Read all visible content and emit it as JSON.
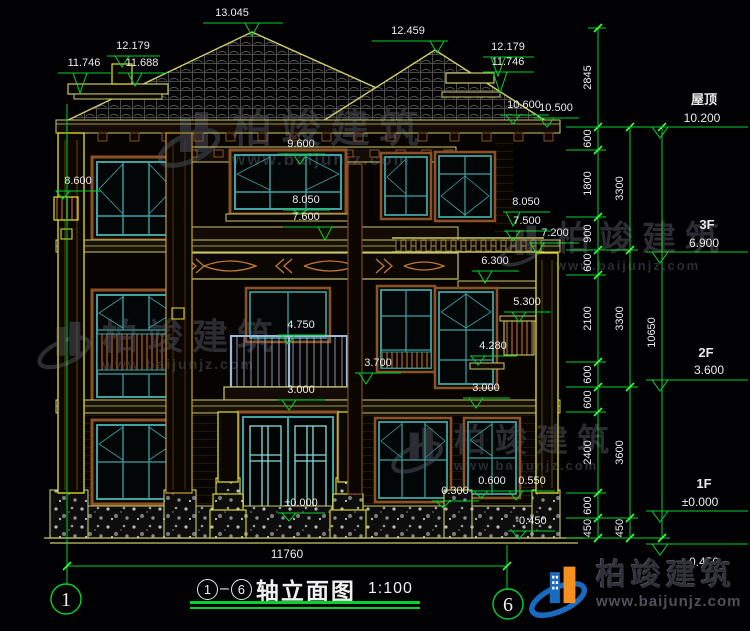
{
  "title_block": {
    "axis_start": "1",
    "axis_end": "6",
    "title": "轴立面图",
    "scale": "1:100"
  },
  "axis_bubbles": {
    "left": "1",
    "right": "6"
  },
  "bottom_dim": {
    "value": "11760"
  },
  "watermark": {
    "brand": "柏竣建筑",
    "url": "www.baijunjz.com"
  },
  "colors": {
    "dim_green": "#00d32d",
    "tick_green": "#3dff3d",
    "text_white": "#ececec",
    "khaki": "#c9c96b",
    "yellow": "#e6e22e",
    "teal": "#3fa3a3",
    "brown": "#8a5226",
    "logo_blue": "#1a6ac0",
    "logo_orange": "#f5901e"
  },
  "elevation_markers": [
    {
      "v": "13.045",
      "tx": 232,
      "ty": 16,
      "x1": 203,
      "x2": 283,
      "ly": 23,
      "ax": 252,
      "ay": 36
    },
    {
      "v": "12.459",
      "tx": 408,
      "ty": 34,
      "x1": 372,
      "x2": 448,
      "ly": 41,
      "ax": 437,
      "ay": 53
    },
    {
      "v": "12.179",
      "tx": 133,
      "ty": 49,
      "x1": 107,
      "x2": 160,
      "ly": 56,
      "ax": 122,
      "ay": 67
    },
    {
      "v": "11.746",
      "tx": 84,
      "ty": 66,
      "x1": 58,
      "x2": 112,
      "ly": 73,
      "ax": 80,
      "ay": 93
    },
    {
      "v": "11.688",
      "tx": 142,
      "ty": 66,
      "x1": 118,
      "x2": 168,
      "ly": 73,
      "ax": 135,
      "ay": 86
    },
    {
      "v": "12.179",
      "tx": 508,
      "ty": 50,
      "x1": 483,
      "x2": 534,
      "ly": 57,
      "ax": 498,
      "ay": 76
    },
    {
      "v": "11.746",
      "tx": 508,
      "ty": 65,
      "x1": 483,
      "x2": 534,
      "ly": 72,
      "ax": 500,
      "ay": 93
    },
    {
      "v": "10.600",
      "tx": 524,
      "ty": 108,
      "x1": 500,
      "x2": 549,
      "ly": 115,
      "ax": 513,
      "ay": 124
    },
    {
      "v": "10.500",
      "tx": 556,
      "ty": 111,
      "x1": 534,
      "x2": 579,
      "ly": 118,
      "ax": 547,
      "ay": 127
    },
    {
      "v": "9.600",
      "tx": 301,
      "ty": 147,
      "x1": 278,
      "x2": 325,
      "ly": 154,
      "ax": 300,
      "ay": 164
    },
    {
      "v": "8.600",
      "tx": 78,
      "ty": 184,
      "x1": 56,
      "x2": 101,
      "ly": 191,
      "ax": 63,
      "ay": 199
    },
    {
      "v": "8.050",
      "tx": 306,
      "ty": 203,
      "x1": 283,
      "x2": 330,
      "ly": 210,
      "ax": 300,
      "ay": 214
    },
    {
      "v": "7.600",
      "tx": 306,
      "ty": 220,
      "x1": 283,
      "x2": 330,
      "ly": 227,
      "ax": 325,
      "ay": 240
    },
    {
      "v": "8.050",
      "tx": 526,
      "ty": 205,
      "x1": 503,
      "x2": 550,
      "ly": 212,
      "ax": 513,
      "ay": 226
    },
    {
      "v": "7.500",
      "tx": 527,
      "ty": 224,
      "x1": 504,
      "x2": 551,
      "ly": 231,
      "ax": 513,
      "ay": 241
    },
    {
      "v": "7.200",
      "tx": 555,
      "ty": 236,
      "x1": 532,
      "x2": 579,
      "ly": 243,
      "ax": 537,
      "ay": 254
    },
    {
      "v": "6.300",
      "tx": 495,
      "ty": 264,
      "x1": 472,
      "x2": 519,
      "ly": 271,
      "ax": 485,
      "ay": 283
    },
    {
      "v": "5.300",
      "tx": 527,
      "ty": 305,
      "x1": 504,
      "x2": 551,
      "ly": 312,
      "ax": 519,
      "ay": 322
    },
    {
      "v": "4.750",
      "tx": 301,
      "ty": 328,
      "x1": 278,
      "x2": 325,
      "ly": 335,
      "ax": 288,
      "ay": 344
    },
    {
      "v": "4.280",
      "tx": 493,
      "ty": 349,
      "x1": 470,
      "x2": 517,
      "ly": 356,
      "ax": 478,
      "ay": 365
    },
    {
      "v": "3.700",
      "tx": 378,
      "ty": 366,
      "x1": 355,
      "x2": 401,
      "ly": 373,
      "ax": 366,
      "ay": 384
    },
    {
      "v": "3.000",
      "tx": 301,
      "ty": 393,
      "x1": 278,
      "x2": 325,
      "ly": 400,
      "ax": 289,
      "ay": 410
    },
    {
      "v": "3.000",
      "tx": 486,
      "ty": 391,
      "x1": 463,
      "x2": 510,
      "ly": 398,
      "ax": 476,
      "ay": 408
    },
    {
      "v": "0.600",
      "tx": 492,
      "ty": 484,
      "x1": 469,
      "x2": 516,
      "ly": 491,
      "ax": 481,
      "ay": 498
    },
    {
      "v": "0.550",
      "tx": 532,
      "ty": 484,
      "x1": 510,
      "x2": 555,
      "ly": 491,
      "ax": 516,
      "ay": 500
    },
    {
      "v": "0.300",
      "tx": 455,
      "ty": 494,
      "x1": 432,
      "x2": 479,
      "ly": 501,
      "ax": 443,
      "ay": 508
    },
    {
      "v": "±0.000",
      "tx": 301,
      "ty": 506,
      "x1": 278,
      "x2": 325,
      "ly": 513,
      "ax": 289,
      "ay": 521
    },
    {
      "v": "-0.450",
      "tx": 531,
      "ty": 524,
      "x1": 508,
      "x2": 555,
      "ly": 531,
      "ax": 519,
      "ay": 539
    }
  ],
  "dim_chains": [
    {
      "x": 598,
      "bounds": [
        28,
        127,
        150,
        217,
        250,
        275,
        362,
        387,
        412,
        493,
        518,
        538
      ],
      "values": [
        "2845",
        "600",
        "1800",
        "900",
        "600",
        "2100",
        "600",
        "600",
        "2400",
        "600",
        "450"
      ]
    },
    {
      "x": 630,
      "bounds": [
        127,
        250,
        387,
        518,
        538
      ],
      "values": [
        "3300",
        "3300",
        "3600",
        "450"
      ]
    },
    {
      "x": 662,
      "bounds": [
        127,
        538
      ],
      "values": [
        "10650"
      ]
    }
  ],
  "floor_markers": [
    {
      "label": "屋顶",
      "value": "10.200",
      "lx": 704,
      "lyt": 104,
      "vx": 702,
      "vyt": 122,
      "ly": 127,
      "below": false
    },
    {
      "label": "3F",
      "value": "6.900",
      "lx": 707,
      "lyt": 229,
      "vx": 704,
      "vyt": 247,
      "ly": 252,
      "below": false
    },
    {
      "label": "2F",
      "value": "3.600",
      "lx": 706,
      "lyt": 357,
      "vx": 709,
      "vyt": 374,
      "ly": 380,
      "below": false
    },
    {
      "label": "1F",
      "value": "±0.000",
      "lx": 704,
      "lyt": 488,
      "vx": 700,
      "vyt": 506,
      "ly": 511,
      "below": false
    },
    {
      "label": "",
      "value": "-0.450",
      "lx": 702,
      "lyt": 0,
      "vx": 702,
      "vyt": 566,
      "ly": 544,
      "below": true
    }
  ]
}
